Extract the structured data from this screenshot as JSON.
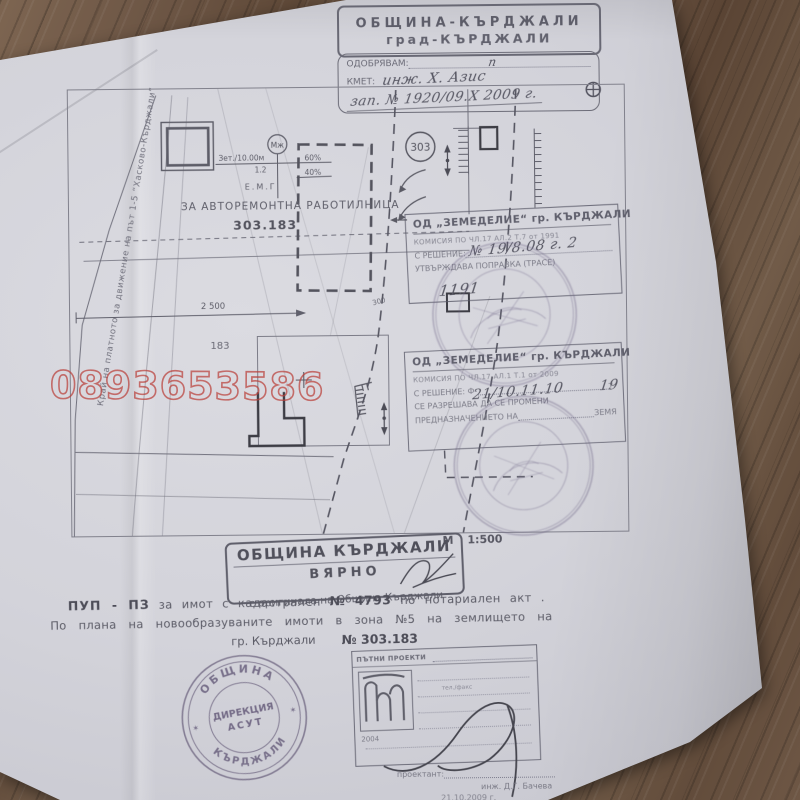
{
  "colors": {
    "wood": "#6b5342",
    "paper": "#d5d4da",
    "ink": "#5a5a66",
    "watermark_red": "#ba403a",
    "stamp_purple": "#756b90"
  },
  "watermark": {
    "phone": "0893653586"
  },
  "header": {
    "org_line1": "ОБЩИНА-КЪРДЖАЛИ",
    "org_line2": "град-КЪРДЖАЛИ",
    "approve_label": "ОДОБРЯВАМ:",
    "approve_note": "п",
    "mayor_label": "КМЕТ:",
    "mayor_name": "инж. Х. Азис",
    "order_note": "зап. № 1920/09.X 2009 г."
  },
  "plan": {
    "edge_label": "Край на платното за движение на път  1-5 “Хасково-Кърджали”",
    "circle_mzh": "Мж",
    "density_line": "Зет./10.00м",
    "pct_60": "60%",
    "floors": "1.2",
    "pct_40": "40%",
    "emg": "Е.М.Г",
    "purpose": "ЗА АВТОРЕМОНТНА РАБОТИЛНИЦА",
    "parcel_no": "303.183",
    "parcel_183": "183",
    "dim_2500": "2 500",
    "dim_300": "300",
    "circle_303": "303"
  },
  "scale": {
    "label": "М",
    "value": "1:500"
  },
  "stamp_box_1": {
    "title": "ОД „ЗЕМЕДЕЛИЕ“ гр. КЪРДЖАЛИ",
    "commission": "КОМИСИЯ ПО ЧЛ.17 АЛ.2 Т.7 от 1991",
    "decision_label": "С РЕШЕНИЕ:",
    "decision_value": "№ 19/8.08 г. 2",
    "approves": "УТВЪРЖДАВА ПОПРАВКА (ТРАСЕ)",
    "hand_note": "1191"
  },
  "stamp_box_2": {
    "title": "ОД „ЗЕМЕДЕЛИЕ“ гр. КЪРДЖАЛИ",
    "commission": "КОМИСИЯ ПО ЧЛ.17 АЛ.1 Т.1 от 2009",
    "decision_label": "С РЕШЕНИЕ: Ф-",
    "decision_value": "21/10.11.10",
    "decision_item_label": "т.",
    "decision_item": "19",
    "allows": "СЕ РАЗРЕШАВА ДА СЕ ПРОМЕНИ",
    "purpose_label": "ПРЕДНАЗНАЧЕНИЕТО НА",
    "purpose_value": "ЗЕМЯ"
  },
  "certify": {
    "title": "ОБЩИНА КЪРДЖАЛИ",
    "true_label": "ВЯРНО",
    "subtitle": "с оригинала на Община Кърджали"
  },
  "description": {
    "line1_prefix": "ПУП - ПЗ",
    "line1_mid": "за имот с кадастрален",
    "line1_num": "№ 4793",
    "line1_end": "по нотариален акт .",
    "line2": "По плана на новообразуваните имоти в зона №5 на землището на",
    "line3_city": "гр. Кърджали",
    "line3_no": "№ 303.183"
  },
  "seal": {
    "arc_top": "ОБЩИНА",
    "center1": "ДИРЕКЦИЯ",
    "center2": "АСУТ",
    "arc_bottom": "КЪРДЖАЛИ",
    "star": "✶"
  },
  "title_block": {
    "company": "ПЪТНИ ПРОЕКТИ",
    "phone_label": "тел./факс",
    "year": "2004",
    "designer_label": "проектант:",
    "designer_name": "инж. Д.Г. Бачева",
    "date": "21.10.2009 г."
  }
}
